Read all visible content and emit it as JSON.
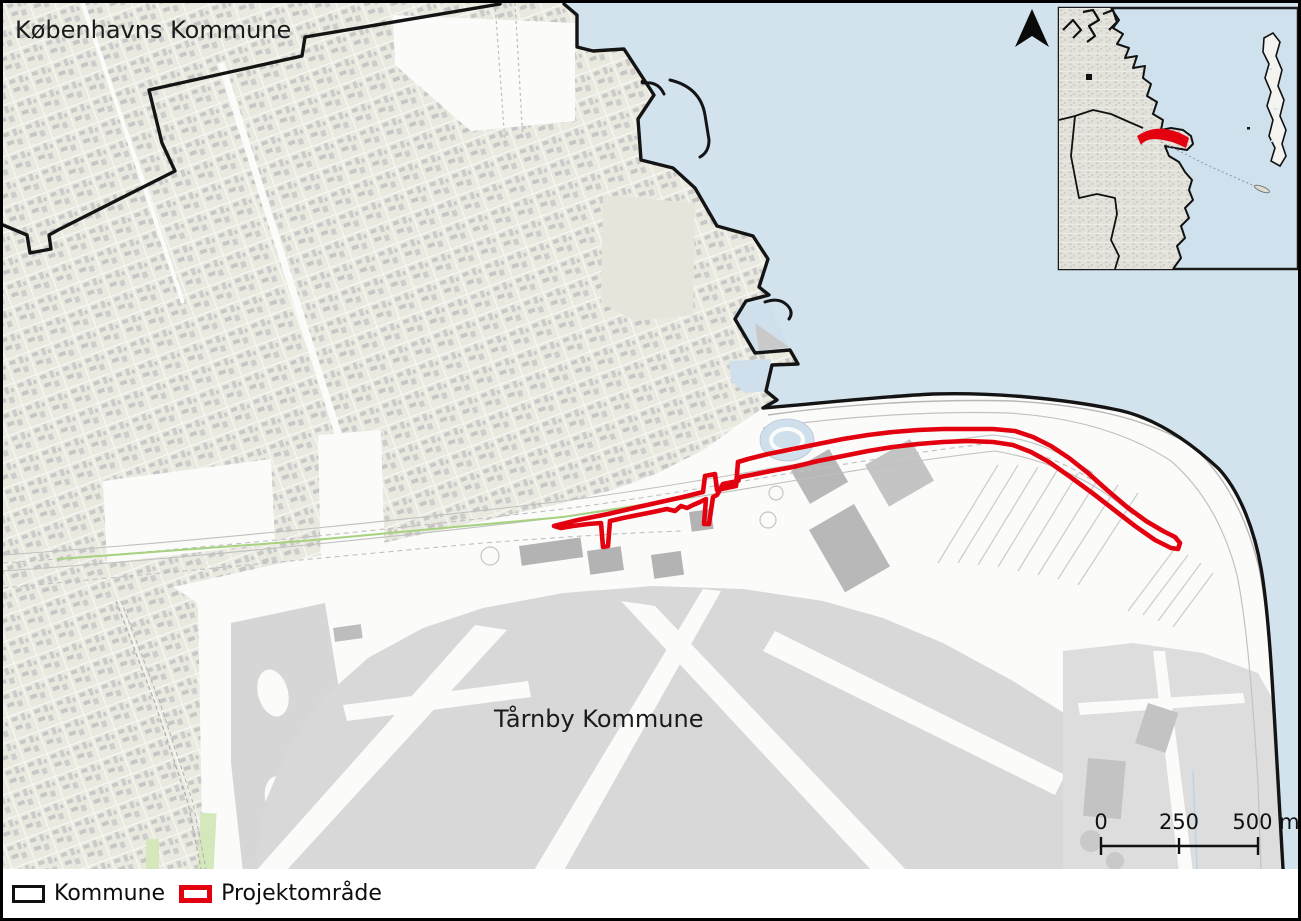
{
  "map": {
    "labels": {
      "municipality_top": "Københavns Kommune",
      "municipality_bottom": "Tårnby Kommune"
    },
    "scale_bar": {
      "tick_0": "0",
      "tick_250": "250",
      "tick_500": "500 m"
    },
    "colors": {
      "project_area_red": "#e3000f",
      "water_blue": "#d3e3ee",
      "boundary_black": "#141414",
      "land_beige": "#eae9e0",
      "airport_gray": "#d8d8d8"
    }
  },
  "legend": {
    "items": [
      {
        "label": "Kommune",
        "swatch": "black-outline"
      },
      {
        "label": "Projektområde",
        "swatch": "red-outline"
      }
    ]
  }
}
